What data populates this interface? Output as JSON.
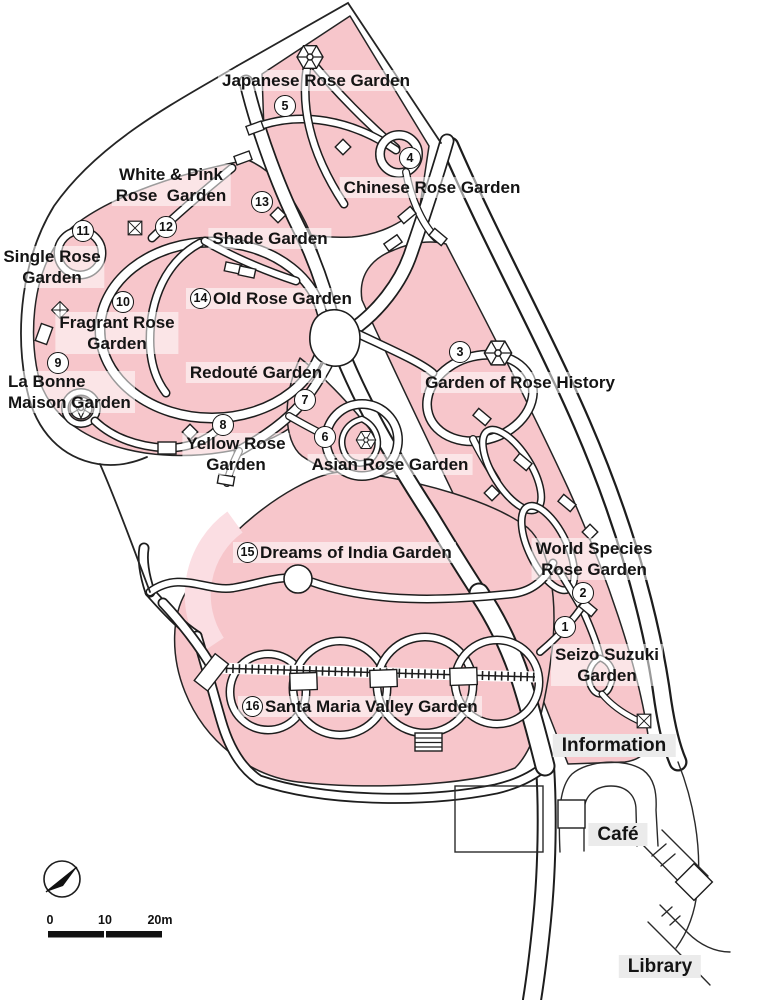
{
  "map_title": "Rose Garden Park Map",
  "colors": {
    "region_pink": "#f7c6cb",
    "region_light_pink": "#fbdee3",
    "path_white": "#ffffff",
    "line_black": "#1d1d1d",
    "label_bg": "rgba(255,255,255,0.55)",
    "facility_label_bg": "#ebebeb"
  },
  "gardens": [
    {
      "id": "japanese",
      "label": "Japanese Rose Garden"
    },
    {
      "id": "chinese",
      "label": "Chinese Rose Garden"
    },
    {
      "id": "white_pink",
      "label": "White & Pink\nRose  Garden"
    },
    {
      "id": "shade",
      "label": "Shade Garden"
    },
    {
      "id": "single",
      "label": "Single Rose\nGarden"
    },
    {
      "id": "old_rose",
      "number": "14",
      "label": "Old Rose Garden"
    },
    {
      "id": "fragrant",
      "label": "Fragrant Rose\nGarden"
    },
    {
      "id": "la_bonne",
      "label": "La Bonne\nMaison Garden"
    },
    {
      "id": "redoute",
      "label": "Redouté Garden"
    },
    {
      "id": "yellow",
      "label": "Yellow Rose\nGarden"
    },
    {
      "id": "asian",
      "label": "Asian Rose Garden"
    },
    {
      "id": "history",
      "label": "Garden of Rose History"
    },
    {
      "id": "dreams",
      "number": "15",
      "label": "Dreams of India Garden"
    },
    {
      "id": "world",
      "label": "World Species\nRose Garden"
    },
    {
      "id": "seizo",
      "label": "Seizo Suzuki\nGarden"
    },
    {
      "id": "santa_maria",
      "number": "16",
      "label": "Santa Maria Valley Garden"
    }
  ],
  "markers": [
    {
      "n": "5"
    },
    {
      "n": "4"
    },
    {
      "n": "13"
    },
    {
      "n": "11"
    },
    {
      "n": "12"
    },
    {
      "n": "10"
    },
    {
      "n": "9"
    },
    {
      "n": "7"
    },
    {
      "n": "8"
    },
    {
      "n": "6"
    },
    {
      "n": "3"
    },
    {
      "n": "2"
    },
    {
      "n": "1"
    }
  ],
  "facilities": [
    {
      "id": "information",
      "label": "Information"
    },
    {
      "id": "cafe",
      "label": "Café"
    },
    {
      "id": "library",
      "label": "Library"
    }
  ],
  "scale_bar": {
    "ticks": [
      "0",
      "10",
      "20m"
    ]
  },
  "compass": {
    "needle_direction": "north-east"
  },
  "icons": [
    {
      "name": "gazebo-icon",
      "shape": "hexagonal pavilion wheel"
    },
    {
      "name": "point-marker-icon",
      "shape": "boxed X"
    },
    {
      "name": "junction-diamond-icon",
      "shape": "rotated square"
    },
    {
      "name": "compass-icon",
      "shape": "needle in circle pointing north-east"
    }
  ]
}
